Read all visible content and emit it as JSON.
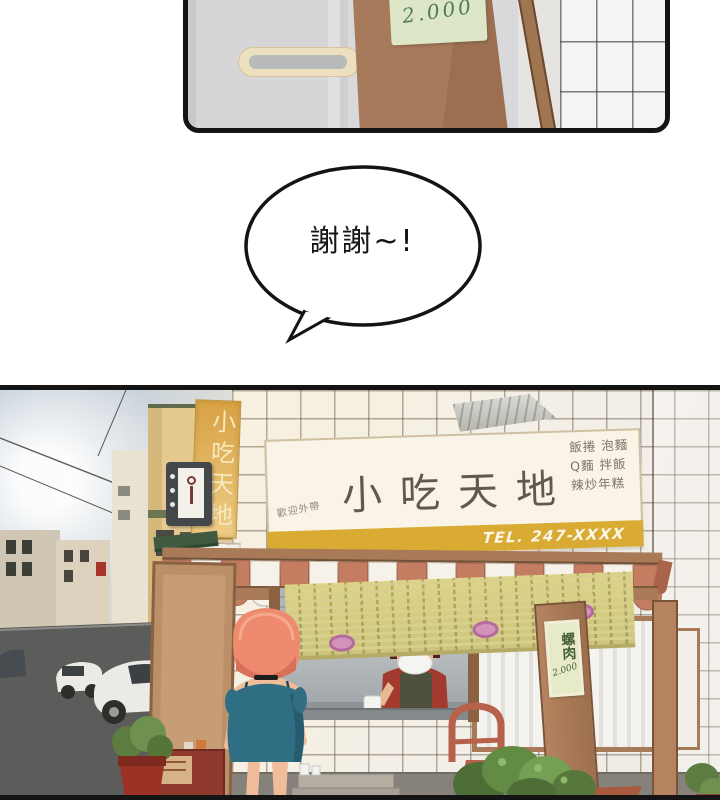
{
  "page": {
    "background": "#ffffff"
  },
  "top_panel": {
    "note_price": "2.000"
  },
  "speech_bubble": {
    "text": "謝謝~!"
  },
  "storefront": {
    "vertical_sign_text": "小吃天地",
    "main_sign": {
      "welcome": "歡迎外帶",
      "name": "小吃天地",
      "menu_lines": [
        "飯捲 泡麵",
        "Q麵 拌飯",
        "辣炒年糕"
      ],
      "phone": "TEL. 247-XXXX"
    },
    "post_note": {
      "item": "螺肉",
      "price": "2.000"
    },
    "palette": {
      "awning_terracotta": "#c57d61",
      "awning_cream": "#f7f2e9",
      "wood_brown": "#a87a58",
      "sign_cream": "#f9f4e7",
      "phone_strip_yellow": "#d9ab33",
      "vertical_sign_gold": "#ddab55",
      "menu_banner_green": "#d6cc85",
      "note_green_paper": "#e4e9c8",
      "hair_coral": "#ee8a6e",
      "dress_teal": "#2e6b80",
      "cap_red": "#c33a2c",
      "street_gray": "#5c5c5a"
    }
  }
}
